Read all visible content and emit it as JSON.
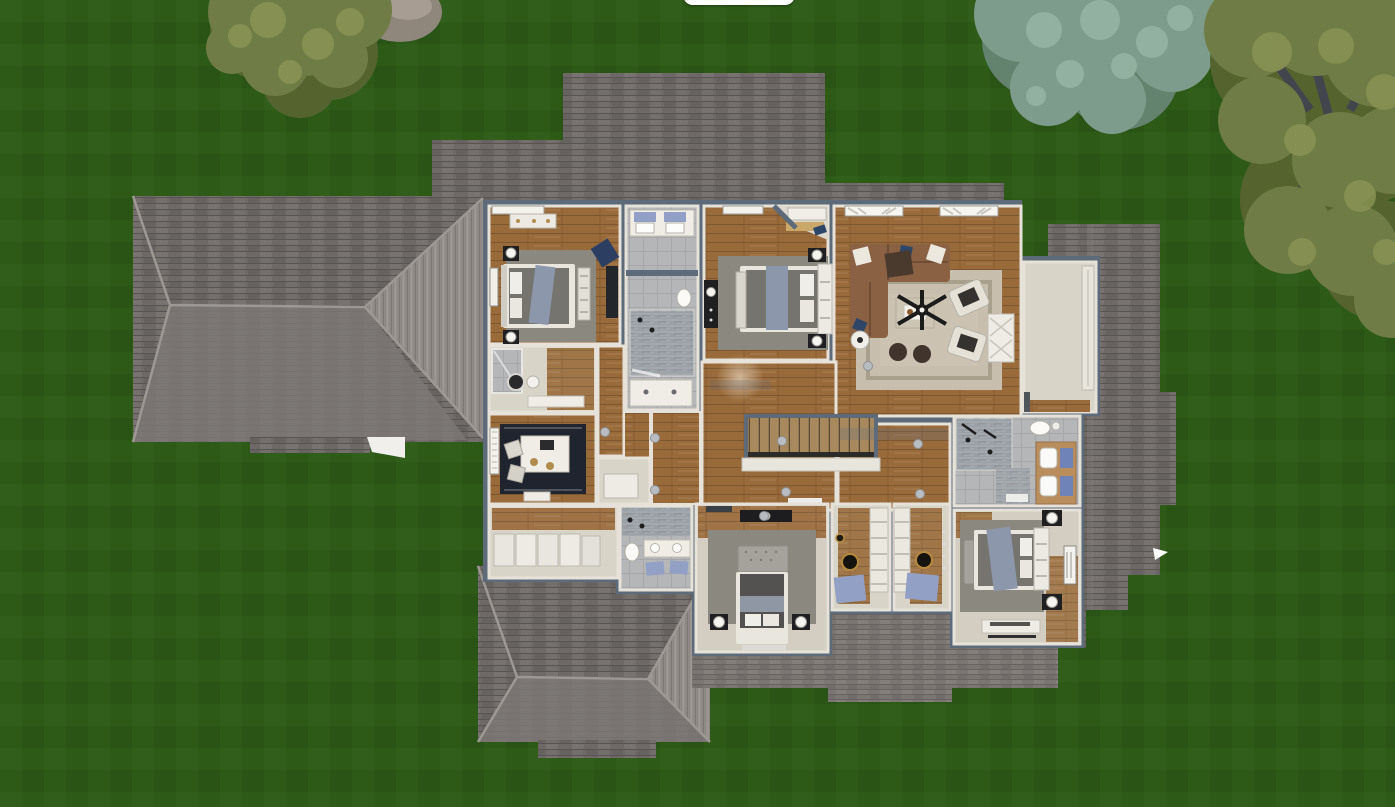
{
  "app": {
    "name": "3d-home-design-viewer",
    "view": "top-down-3d-floorplan-render",
    "toolbar": {
      "visible_edge": true,
      "position": "top-center"
    }
  },
  "palette": {
    "grass": "#2d5a17",
    "grass-dark": "#27511380",
    "pill": "#ffffff",
    "roof": "#6e6966",
    "roof-light": "#7d7874",
    "roof-bright": "#8e8984",
    "roof-hip": "#9d9893",
    "roof-flat": "#7b7672",
    "wall": "#5c6a79",
    "wall-inner": "#e6e2d9",
    "wood": "#9a6b3a",
    "wood-dark": "#7c5429",
    "wood-shadow": "#5f6f85",
    "tile": "#b4b6b8",
    "tile-wet": "#9aa0a6",
    "carpet": "#d3cec1",
    "beige": "#d9d4c8",
    "rug-gray": "#8b8880",
    "rug-beige": "#c7bead",
    "rug-dark": "#20242e",
    "sofa": "#8a6142",
    "sofa-dark": "#6e4c32",
    "bed-frame": "#e9e6de",
    "mattress": "#76746f",
    "blanket": "#8d97ab",
    "duvet-dark": "#545250",
    "nightstand": "#1f1f22",
    "lamp": "#f5f4f0",
    "mat-blue": "#93a0c6",
    "towel-blue": "#6f83b8",
    "counter": "#f0ede6",
    "stairs": "#a8895e",
    "shelf": "#ebe8e0",
    "tree-olive": "#6f7c45",
    "tree-olive-light": "#8a9455",
    "tree-olive-dark": "#55642f",
    "branch": "#43454d",
    "spruce": "#7e9c8b",
    "spruce-light": "#95b4a3",
    "spruce-dark": "#64836f",
    "rock": "#8f867c",
    "light-dot": "#b9bcc0"
  },
  "scene": {
    "environment": {
      "ground": "lawn",
      "trees_count": 3,
      "rock_count": 1
    },
    "trees": [
      {
        "id": "tree-small-olive",
        "species": "olive-deciduous",
        "cx": 300,
        "cy": 18,
        "r": 115
      },
      {
        "id": "tree-spruce",
        "species": "blue-spruce",
        "cx": 1100,
        "cy": 40,
        "r": 140
      },
      {
        "id": "tree-large-olive",
        "species": "olive-deciduous",
        "cx": 1330,
        "cy": 140,
        "r": 210
      }
    ],
    "rock": {
      "cx": 400,
      "cy": 12,
      "rx": 42,
      "ry": 30
    },
    "house": {
      "roof_sections": [
        "left-hip-roof",
        "top-roof-left",
        "top-roof-main",
        "top-roof-right-strip",
        "right-wing-roof",
        "garage-hip-roof",
        "flat-roof-under-closets",
        "flat-roof-under-bedroom-3",
        "flat-roof-under-bedroom-4"
      ],
      "rooms": [
        {
          "id": "bedroom-1",
          "floor": "wood",
          "furniture": [
            "bed",
            "two-nightstands",
            "ball-lamps",
            "dresser",
            "slat-bench",
            "wall-art",
            "desk",
            "navy-desk-chair",
            "gray-rug",
            "window-blinds"
          ]
        },
        {
          "id": "ensuite-bath",
          "floor": "carpet",
          "furniture": [
            "shower",
            "dark-lid-toilet",
            "vanity"
          ]
        },
        {
          "id": "hall-bath",
          "floor": "tile",
          "furniture": [
            "double-vanity",
            "blue-towels",
            "toilet",
            "glass-shower",
            "second-vanity"
          ]
        },
        {
          "id": "bedroom-2",
          "floor": "wood",
          "furniture": [
            "bed",
            "storage-headboard",
            "two-nightstands",
            "ball-lamps",
            "slat-bench",
            "tall-dresser",
            "gray-rug",
            "corner-closet-shelf",
            "window-blinds"
          ]
        },
        {
          "id": "living-room",
          "floor": "wood",
          "furniture": [
            "sectional-sofa",
            "throw-pillows",
            "coffee-table",
            "two-armchairs",
            "two-ottomans",
            "ceiling-fan",
            "console-table",
            "round-side-table",
            "beige-rug",
            "curtained-windows"
          ]
        },
        {
          "id": "entry-hall",
          "floor": "carpet",
          "furniture": [
            "sliding-closet-doors",
            "front-door"
          ]
        },
        {
          "id": "hallway",
          "floor": "wood",
          "furniture": [
            "staircase",
            "stair-railing",
            "ceiling-lights",
            "door-mat"
          ]
        },
        {
          "id": "office",
          "floor": "wood",
          "furniture": [
            "desk",
            "two-chairs",
            "brass-lamps",
            "dark-rug",
            "window-blinds",
            "side-table"
          ]
        },
        {
          "id": "laundry-room",
          "floor": "carpet",
          "furniture": [
            "cabinet-row"
          ]
        },
        {
          "id": "lower-bath",
          "floor": "tile",
          "furniture": [
            "double-vanity",
            "blue-bath-mats",
            "toilet",
            "shower"
          ]
        },
        {
          "id": "hall-closet",
          "floor": "carpet",
          "furniture": [
            "storage-chest"
          ]
        },
        {
          "id": "bedroom-3",
          "floor": "carpet",
          "furniture": [
            "bed",
            "tufted-bench",
            "two-nightstands",
            "ball-lamps",
            "dark-dresser",
            "gray-rug",
            "white-runner"
          ]
        },
        {
          "id": "walk-in-closet-a",
          "floor": "carpet",
          "furniture": [
            "shelving",
            "blue-bath-mat",
            "pendant-light"
          ]
        },
        {
          "id": "walk-in-closet-b",
          "floor": "carpet",
          "furniture": [
            "shelving",
            "blue-bath-mat",
            "pendant-light"
          ]
        },
        {
          "id": "bathroom-2",
          "floor": "tile",
          "furniture": [
            "walk-in-shower",
            "toilet",
            "double-vanity",
            "blue-towels",
            "door-mat"
          ]
        },
        {
          "id": "bedroom-4",
          "floor": "carpet",
          "furniture": [
            "bed",
            "storage-headboard",
            "tufted-bench",
            "two-nightstands",
            "ball-lamps",
            "dresser",
            "wall-art",
            "gray-rug"
          ]
        }
      ],
      "ceiling_lights": [
        [
          655,
          438
        ],
        [
          782,
          441
        ],
        [
          918,
          444
        ],
        [
          655,
          490
        ],
        [
          786,
          492
        ],
        [
          920,
          494
        ],
        [
          868,
          366
        ],
        [
          605,
          432
        ],
        [
          764,
          516
        ]
      ]
    }
  }
}
